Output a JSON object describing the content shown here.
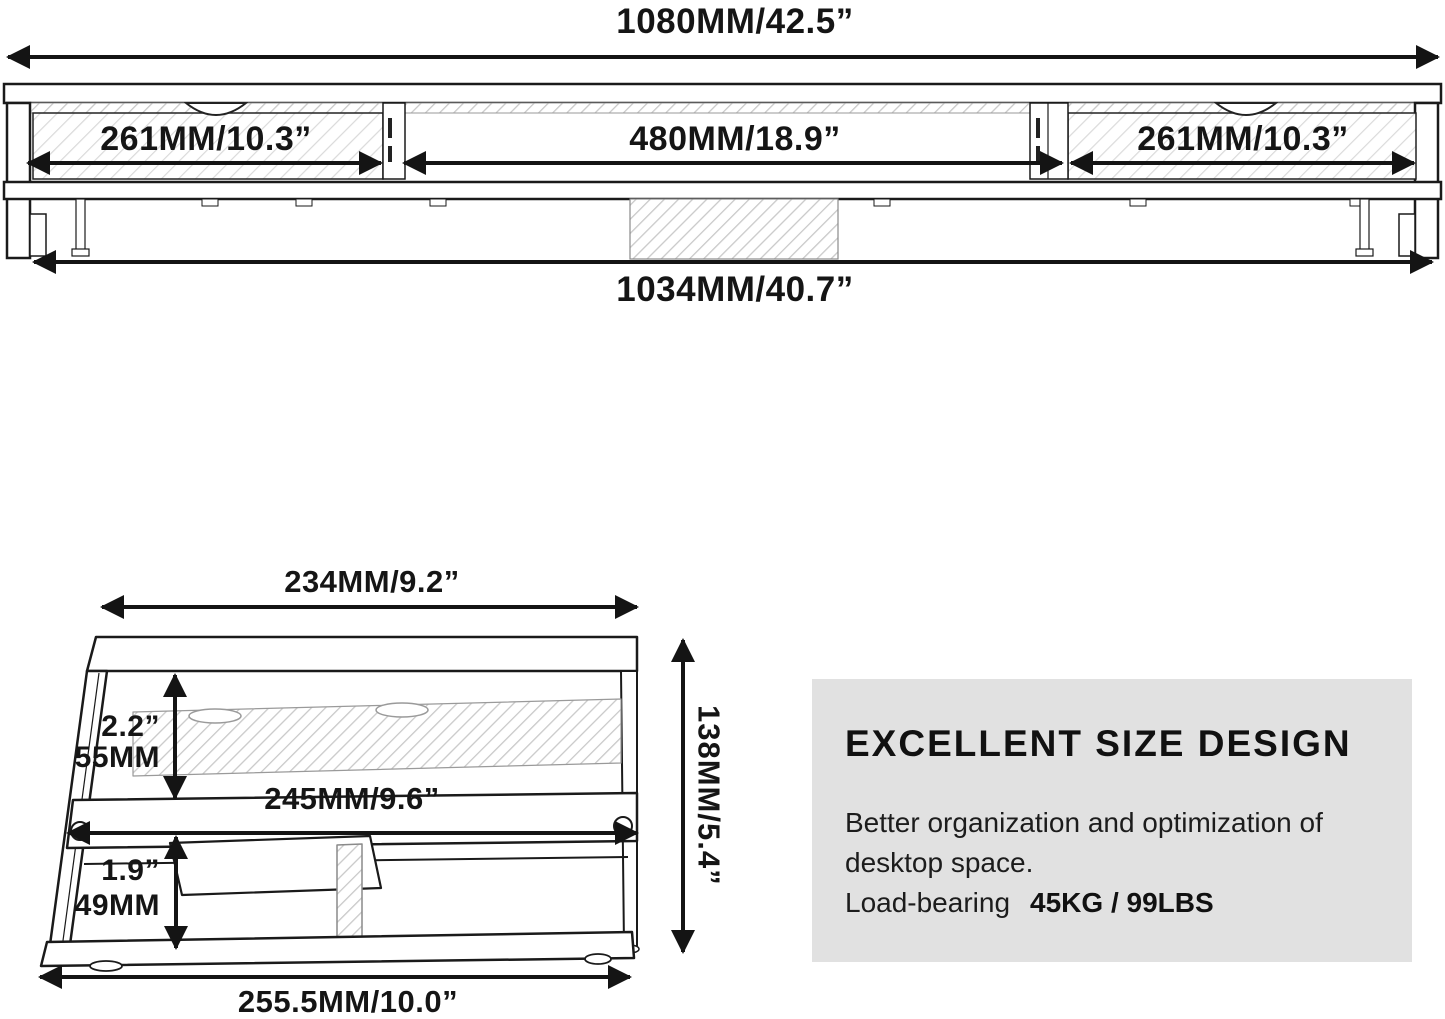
{
  "front_view": {
    "total_width": "1080MM/42.5”",
    "left_section": "261MM/10.3”",
    "middle_section": "480MM/18.9”",
    "right_section": "261MM/10.3”",
    "base_width": "1034MM/40.7”"
  },
  "side_view": {
    "top_depth": "234MM/9.2”",
    "upper_gap_inch": "2.2”",
    "upper_gap_mm": "55MM",
    "shelf_depth": "245MM/9.6”",
    "lower_gap_inch": "1.9”",
    "lower_gap_mm": "49MM",
    "overall_height": "138MM/5.4”",
    "base_depth": "255.5MM/10.0”"
  },
  "info_panel": {
    "title": "EXCELLENT SIZE DESIGN",
    "line1": "Better organization and optimization of",
    "line2": "desktop space.",
    "load_label": "Load-bearing",
    "load_value": "45KG / 99LBS"
  },
  "colors": {
    "background": "#ffffff",
    "line": "#141414",
    "hatch": "#c9c9c9",
    "panel_background": "#e1e1e1"
  }
}
